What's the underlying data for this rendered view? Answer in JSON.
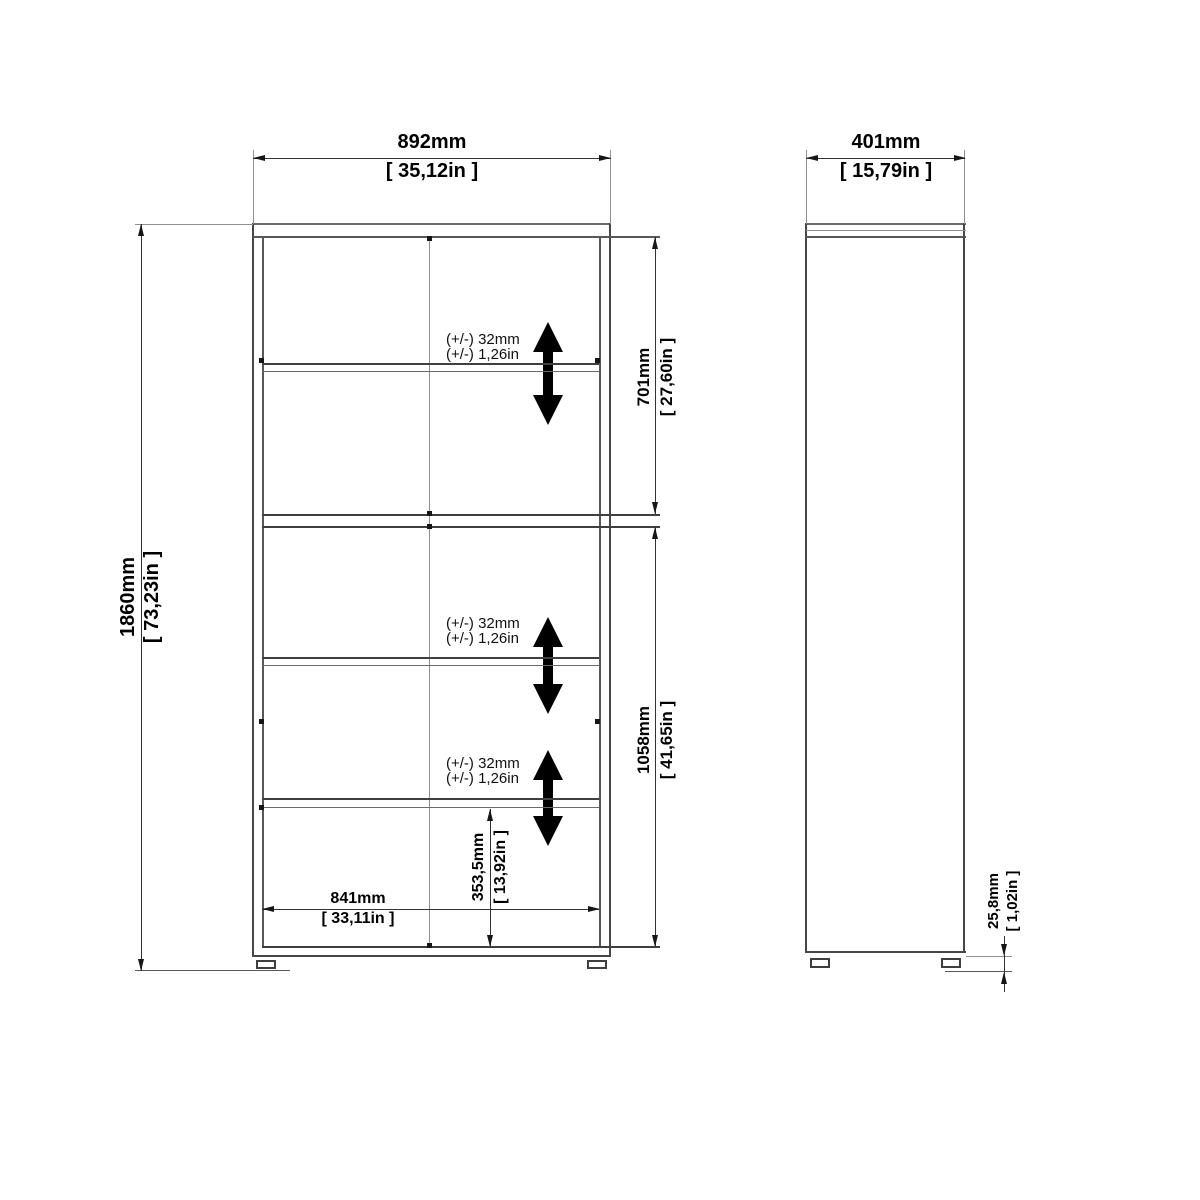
{
  "colors": {
    "background": "#ffffff",
    "line_dark": "#3f3f3f",
    "line_gray": "#8f8f8f",
    "dimension_line": "#333333",
    "arrow_fill": "#000000",
    "text": "#000000"
  },
  "icons": {
    "shelf_adjust_arrow": "double-headed-vertical-arrow"
  },
  "views": {
    "front": {
      "dims": {
        "width": {
          "mm": "892mm",
          "in": "[ 35,12in ]"
        },
        "height": {
          "mm": "1860mm",
          "in": "[ 73,23in ]"
        },
        "upper_section": {
          "mm": "701mm",
          "in": "[ 27,60in ]"
        },
        "lower_section": {
          "mm": "1058mm",
          "in": "[ 41,65in ]"
        },
        "bottom_compartment": {
          "mm": "353,5mm",
          "in": "[ 13,92in ]"
        },
        "interior_width": {
          "mm": "841mm",
          "in": "[ 33,11in ]"
        }
      },
      "shelf_notes": [
        {
          "mm": "(+/-) 32mm",
          "in": "(+/-) 1,26in"
        },
        {
          "mm": "(+/-) 32mm",
          "in": "(+/-) 1,26in"
        },
        {
          "mm": "(+/-) 32mm",
          "in": "(+/-) 1,26in"
        }
      ]
    },
    "side": {
      "dims": {
        "depth": {
          "mm": "401mm",
          "in": "[ 15,79in ]"
        },
        "foot_height": {
          "mm": "25,8mm",
          "in": "[ 1,02in ]"
        }
      }
    }
  }
}
